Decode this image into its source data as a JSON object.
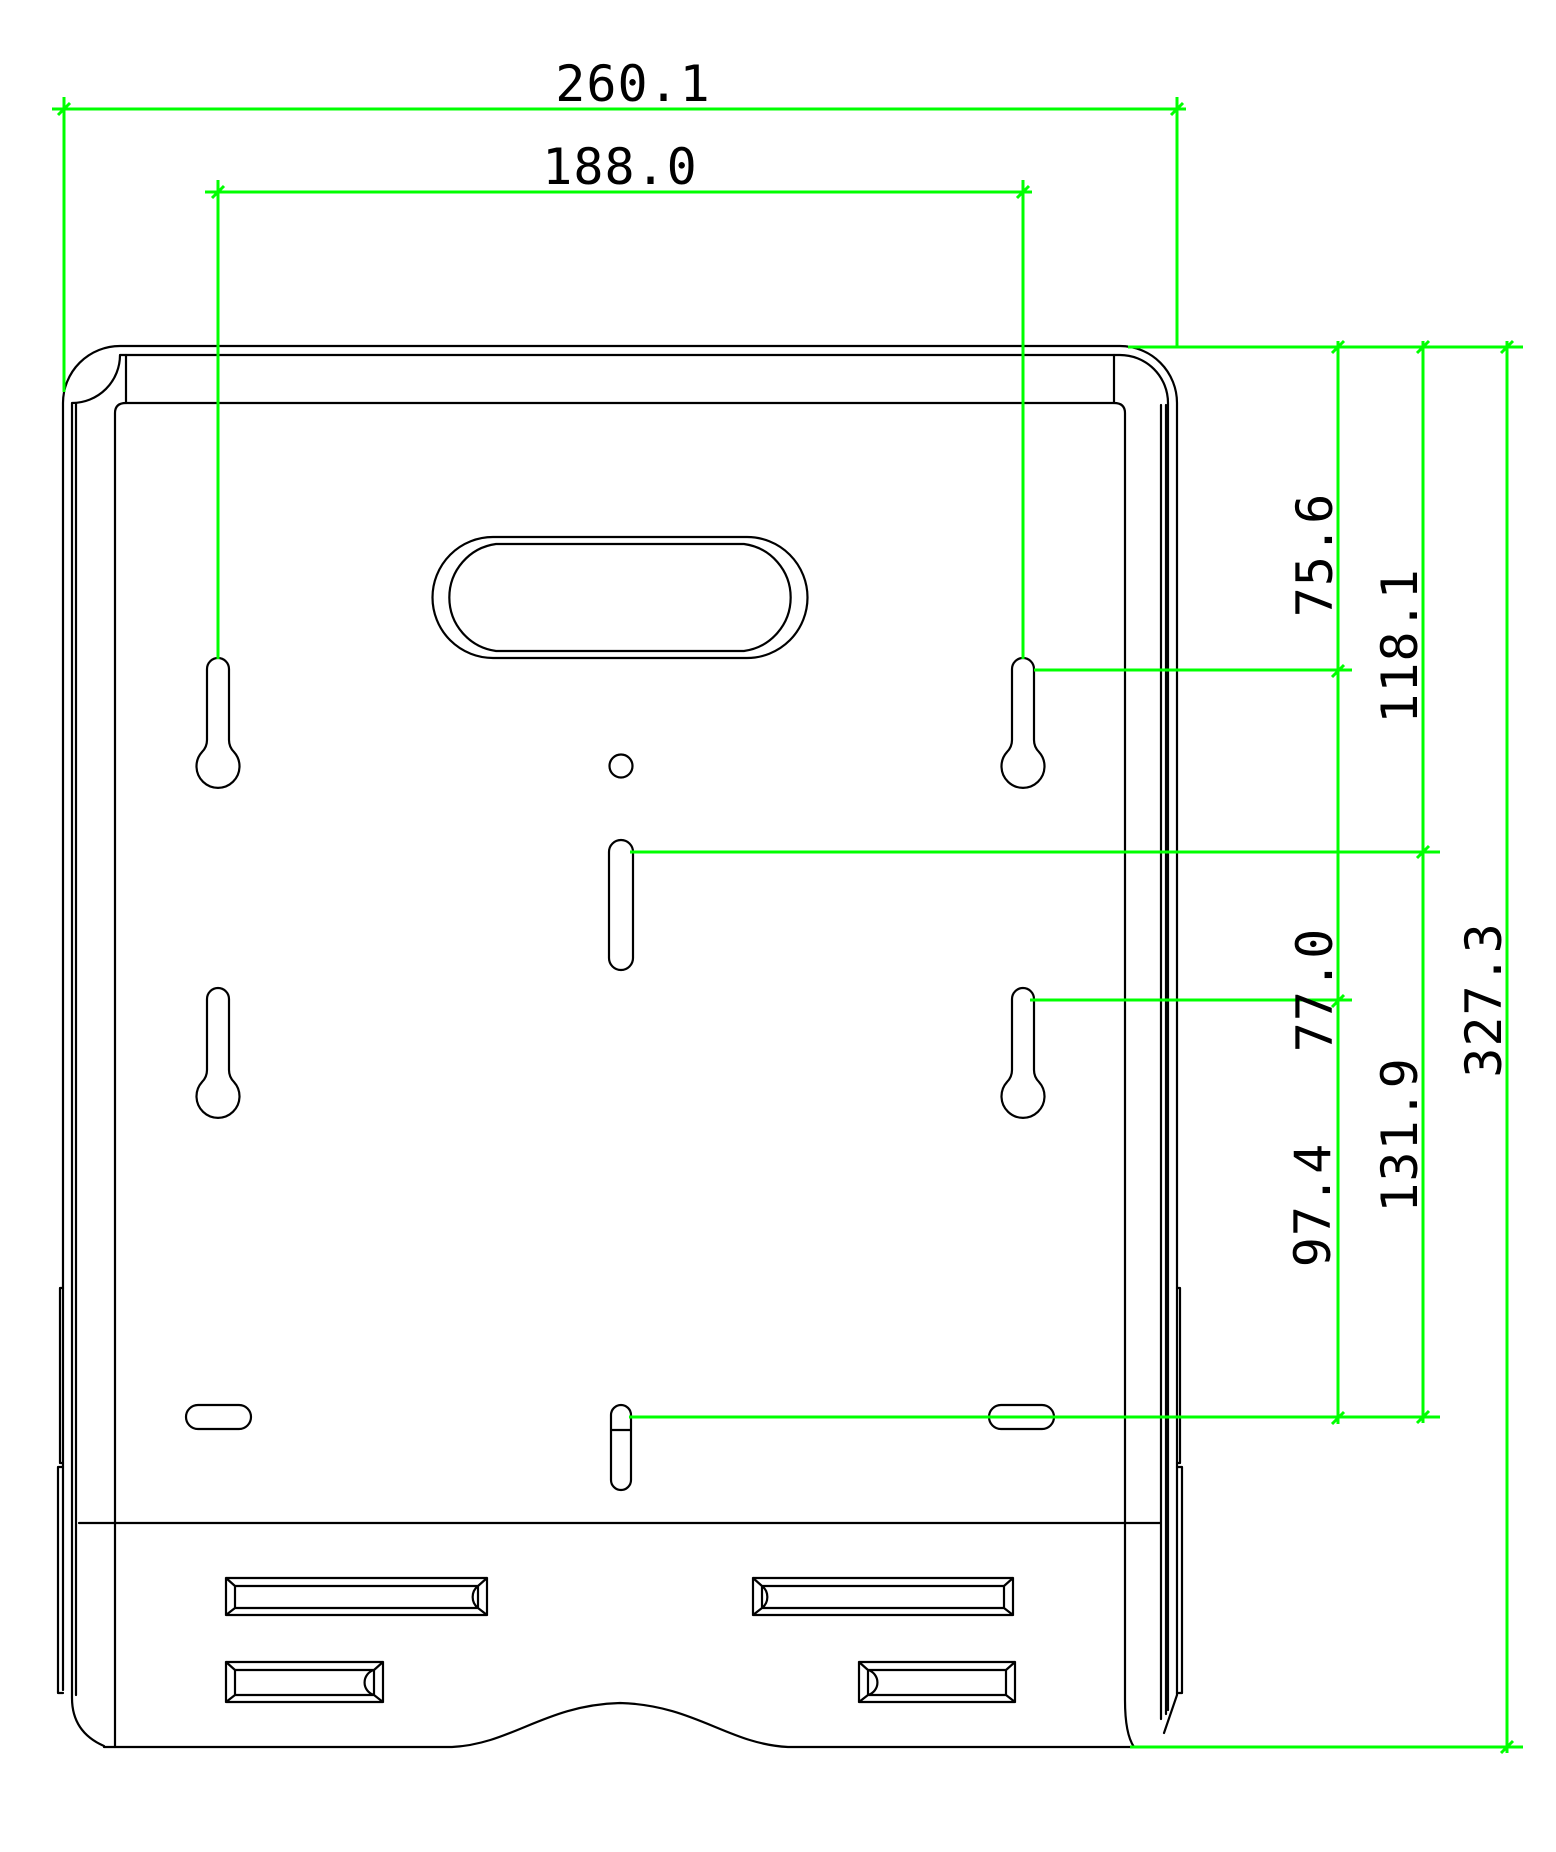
{
  "drawing": {
    "type": "cad-dimension-drawing",
    "colors": {
      "dimension_lines": "#00ff00",
      "geometry_lines": "#000000",
      "background": "#ffffff",
      "text": "#000000"
    },
    "dims": {
      "overall_width": "260.1",
      "hole_span_width": "188.0",
      "top_to_upper_keyhole": "75.6",
      "top_to_center_slot": "118.1",
      "upper_to_lower_keyhole": "77.0",
      "lower_keyhole_to_bottom_slot": "97.4",
      "center_slot_to_bottom_slot": "131.9",
      "overall_height": "327.3"
    }
  }
}
